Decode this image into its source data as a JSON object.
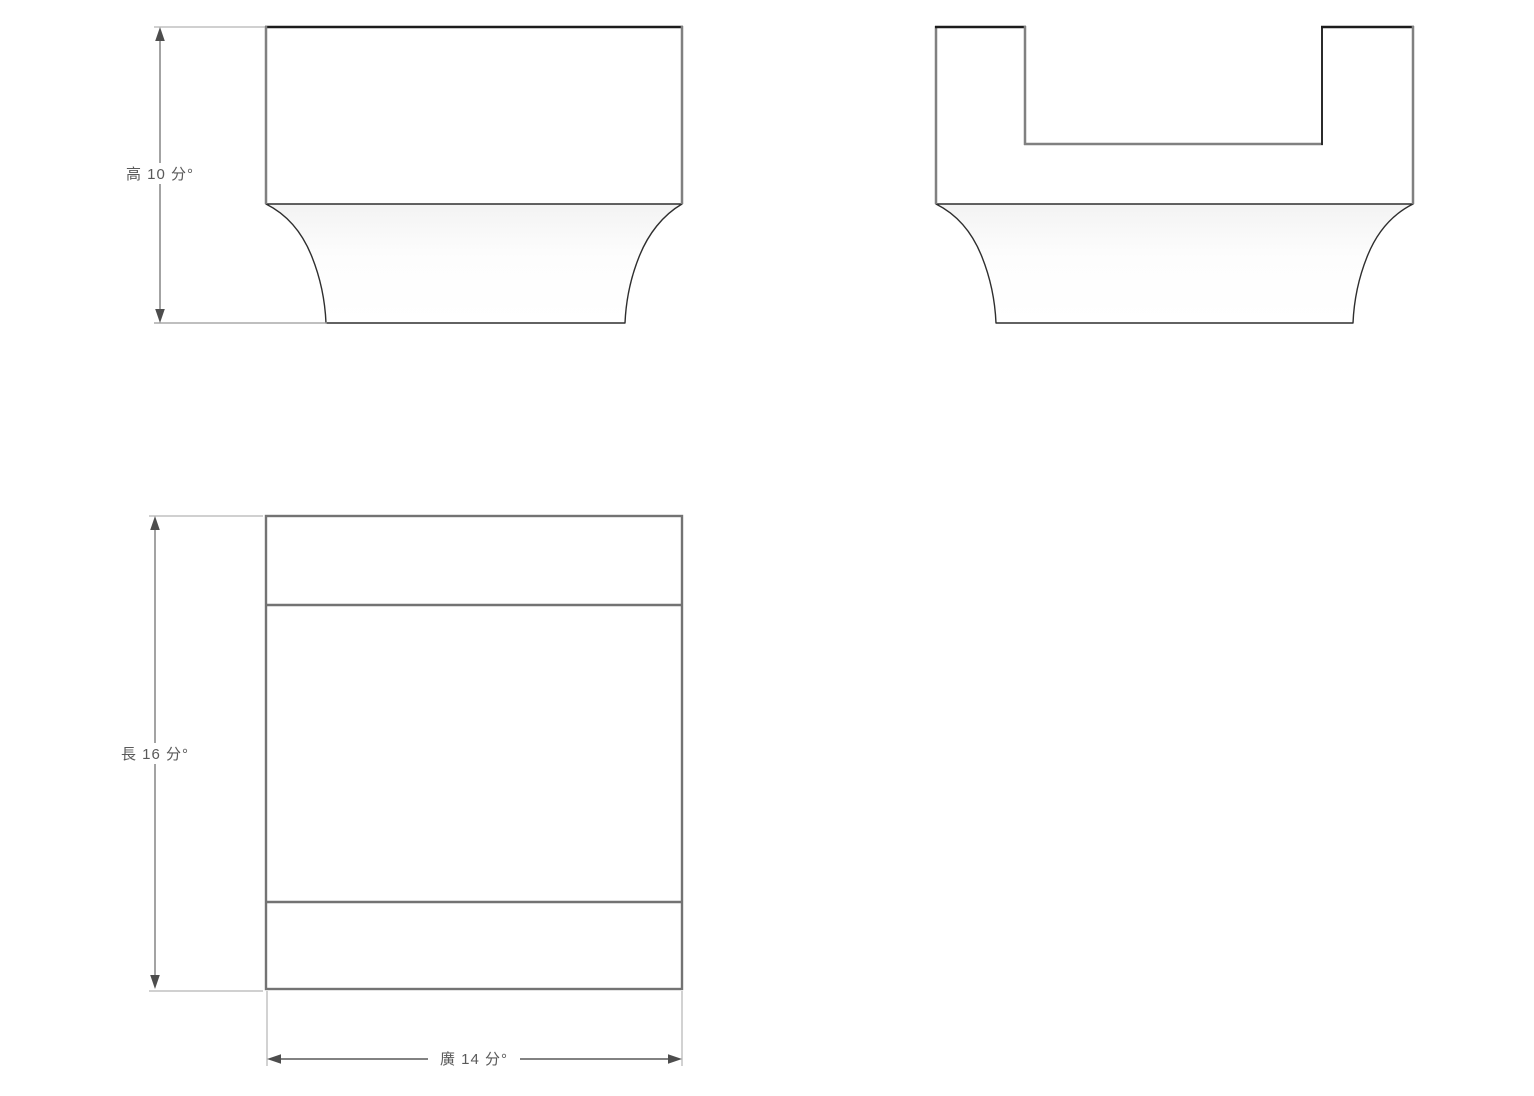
{
  "drawing": {
    "dimensions": {
      "height": {
        "label": "高 10 分°",
        "measure": "高",
        "value": 10,
        "unit": "分°"
      },
      "length": {
        "label": "長 16 分°",
        "measure": "長",
        "value": 16,
        "unit": "分°"
      },
      "width": {
        "label": "廣 14 分°",
        "measure": "廣",
        "value": 14,
        "unit": "分°"
      }
    },
    "colors": {
      "background": "#ffffff",
      "edge_gray": "#808080",
      "edge_dark": "#1c1c1c",
      "plan_edge": "#737373",
      "profile_curve": "#2e2e2e",
      "extension_line": "#b3b3b3",
      "dimension_line": "#8c8c8c",
      "arrowhead": "#4d4d4d",
      "label_text": "#595959",
      "fill_gradient_top": "#f3f3f3"
    }
  }
}
